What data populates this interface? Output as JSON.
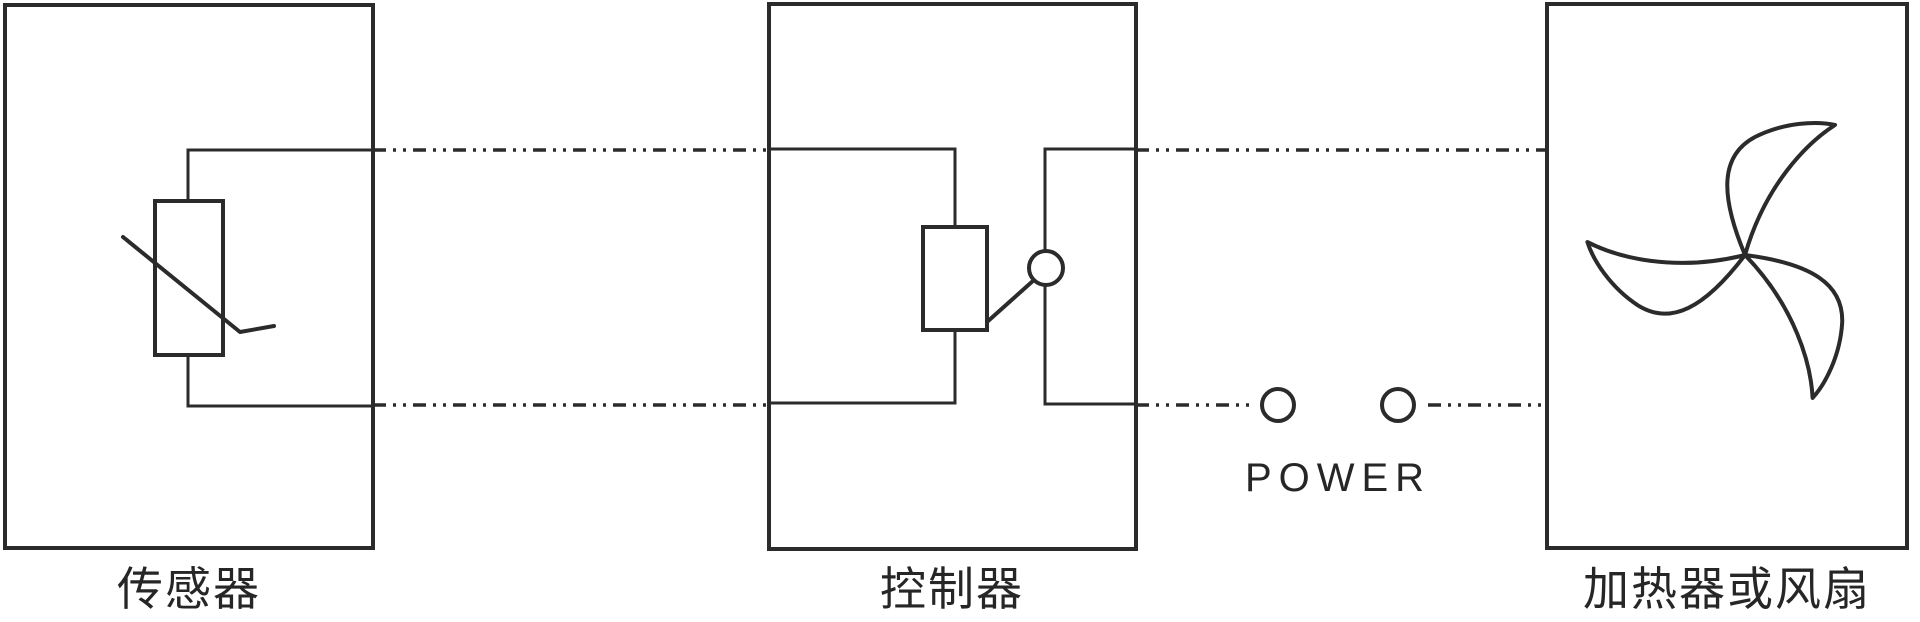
{
  "colors": {
    "background": "#ffffff",
    "line": "#2b2b2b",
    "text": "#262626"
  },
  "blocks": [
    {
      "id": "sensor",
      "label": "传感器"
    },
    {
      "id": "controller",
      "label": "控制器"
    },
    {
      "id": "heater_fan",
      "label": "加热器或风扇"
    }
  ],
  "power": {
    "label": "POWER"
  }
}
